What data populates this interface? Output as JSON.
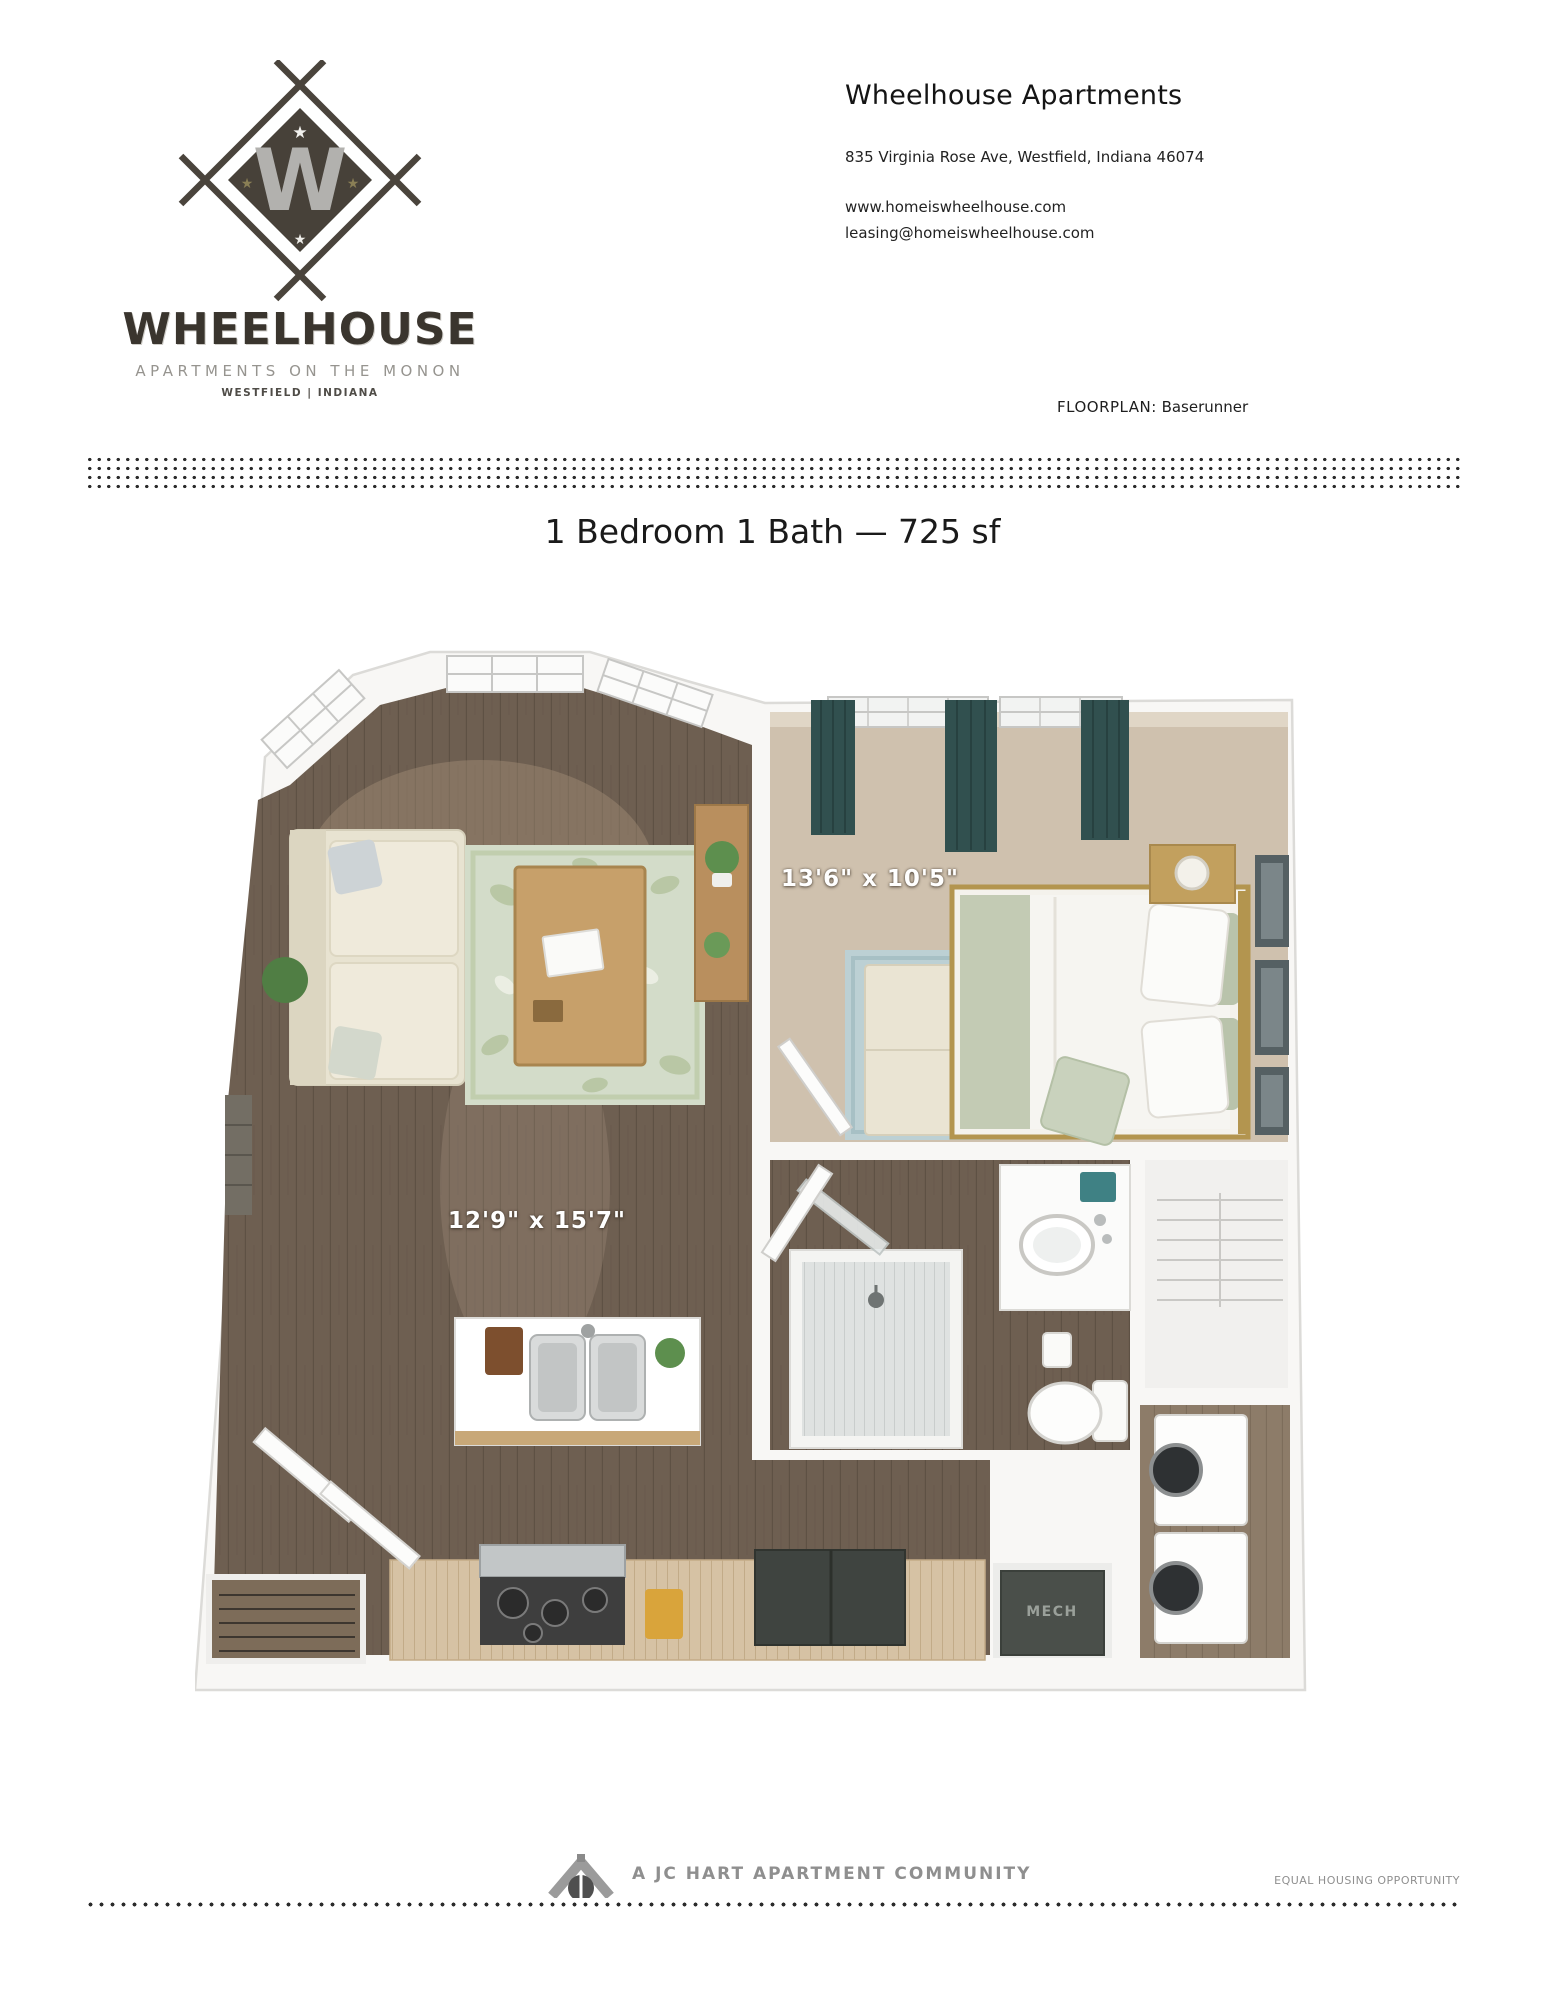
{
  "header": {
    "property_name": "Wheelhouse Apartments",
    "address": "835 Virginia Rose Ave, Westfield, Indiana 46074",
    "website": "www.homeiswheelhouse.com",
    "email": "leasing@homeiswheelhouse.com",
    "floorplan_label": "FLOORPLAN:",
    "floorplan_name": "Baserunner"
  },
  "logo": {
    "monogram": "W",
    "name": "WHEELHOUSE",
    "tagline": "APARTMENTS ON THE MONON",
    "location": "WESTFIELD | INDIANA"
  },
  "floorplan": {
    "title": "1 Bedroom 1 Bath — 725 sf",
    "bedroom_dimensions": "13'6\" x 10'5\"",
    "living_dimensions": "12'9\" x 15'7\"",
    "mech_label": "MECH"
  },
  "footer": {
    "community": "A JC HART APARTMENT COMMUNITY",
    "equal_housing": "EQUAL HOUSING OPPORTUNITY"
  },
  "colors": {
    "wood_floor": "#6e5f51",
    "bedroom_carpet": "#cfc1ae",
    "curtain_teal": "#31504f",
    "logo_dark": "#474139",
    "counter_wood": "#d6c2a4"
  }
}
